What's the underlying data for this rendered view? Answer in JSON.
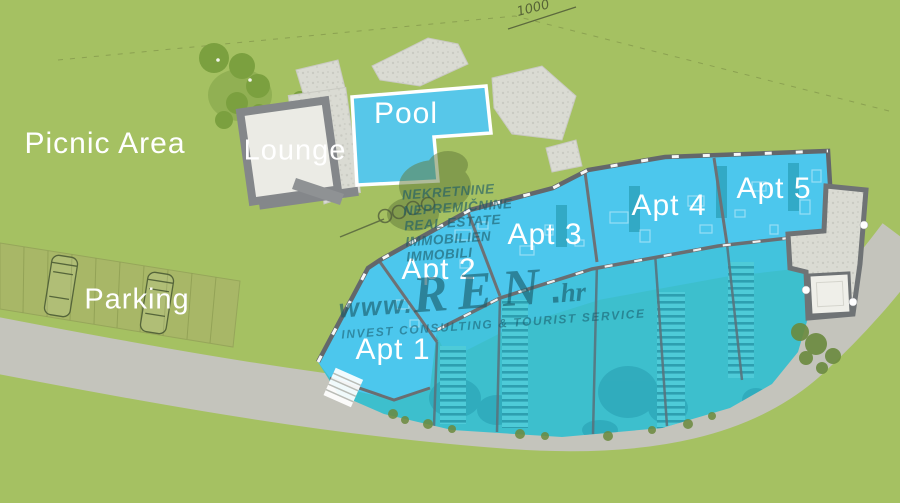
{
  "title": "Apartment complex site plan",
  "labels": {
    "picnic_area": "Picnic Area",
    "lounge": "Lounge",
    "pool": "Pool",
    "parking": "Parking"
  },
  "apartments": [
    {
      "label": "Apt 1"
    },
    {
      "label": "Apt 2"
    },
    {
      "label": "Apt 3"
    },
    {
      "label": "Apt 4"
    },
    {
      "label": "Apt 5"
    }
  ],
  "annotations": {
    "elevation_mark": "1000"
  },
  "watermark": {
    "lines": [
      "NEKRETNINE",
      "NEPREMIČNINE",
      "REAL ESTATE",
      "IMMOBILIEN",
      "IMMOBILI"
    ],
    "brand": {
      "www": "www.",
      "name": "REN",
      "dot": ".",
      "tld": "hr"
    },
    "tagline": "INVEST CONSULTING & TOURIST SERVICE"
  },
  "colors": {
    "grass": "#a5c162",
    "tree_green": "#7ba03f",
    "road_gray": "#c4c4bc",
    "stone_gray": "#dadbd3",
    "wall_gray": "#6a6e71",
    "pool_blue": "#57c7e9",
    "apartment_cyan": "#4cc7ed",
    "terrace_teal": "#3dbfcd",
    "label_white": "#ffffff",
    "watermark_teal": "#1c5a6c"
  }
}
